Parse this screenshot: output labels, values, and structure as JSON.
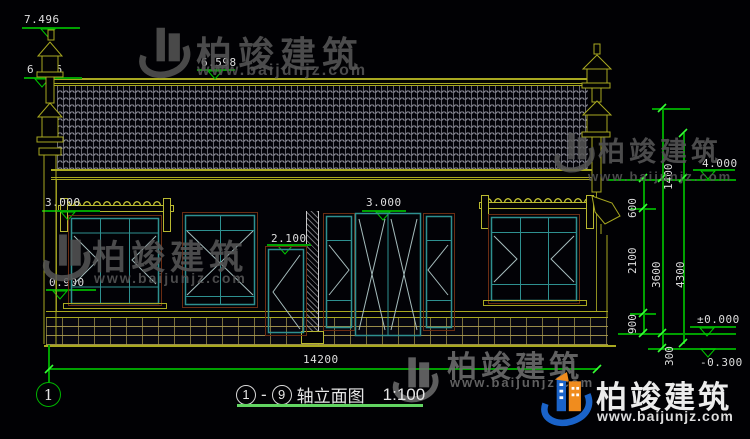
{
  "brand": {
    "name_cn": "柏竣建筑",
    "url": "www.baijunjz.com"
  },
  "title_block": {
    "axis_start": "1",
    "separator": "-",
    "axis_end": "9",
    "label": "轴立面图",
    "scale": "1:100"
  },
  "axis_bubble": {
    "label": "1"
  },
  "elev": {
    "ridge_left": "7.496",
    "gable_left": "6.156",
    "ridge_main": "6.598",
    "awning_left": "3.000",
    "sill_left": "0.900",
    "door_single": "2.100",
    "entrance": "3.000",
    "eave_right": "4.000",
    "ground": "±0.000",
    "below_ground": "-0.300"
  },
  "dims": {
    "total_width": "14200",
    "top_right": "1400",
    "seg600": "600",
    "seg2100": "2100",
    "seg900": "900",
    "seg300": "300",
    "sub3600": "3600",
    "total4300": "4300"
  },
  "colors": {
    "line_yellow": "#a8a820",
    "line_green": "#00a000",
    "tick_green": "#35ff35",
    "frame_teal": "#2e9090",
    "frame_brown": "#6b2c12",
    "dim_text": "#dedede",
    "watermark_gray": "#565656",
    "brand_blue": "#1a63c9",
    "brand_orange": "#f08c1e"
  }
}
